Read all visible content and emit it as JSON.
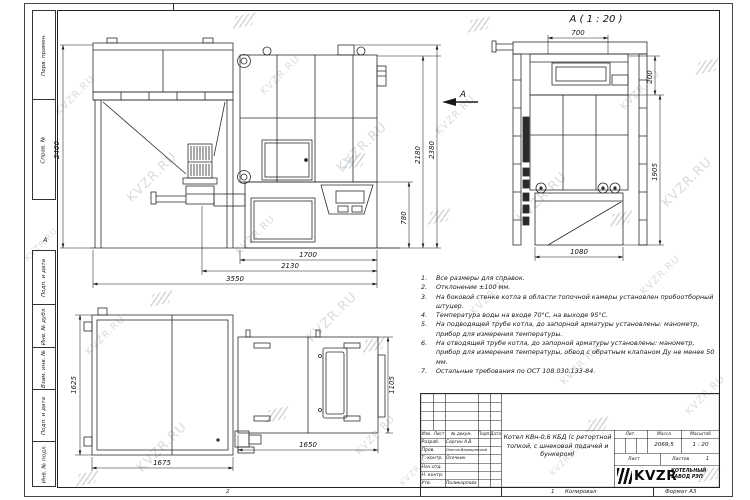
{
  "watermark": "KVZR.RU",
  "frame": {
    "margin_labels": [
      "Перв. примен.",
      "Справ. №",
      "Подп. и дата",
      "Инв. № дубл.",
      "Взам. инв. №",
      "Подп. и дата",
      "Инв. № подл."
    ],
    "zone_letter_a": "А",
    "zone_numbers": {
      "z2": "2",
      "z1": "1"
    },
    "copied_label": "Копировал",
    "format_label": "Формат А3"
  },
  "views": {
    "front": {
      "arrow_label": "А",
      "dims": {
        "bunker_height": "2400",
        "body_height": "2180",
        "total_height": "2380",
        "base_height": "780",
        "width_boiler": "1700",
        "width_mid": "2130",
        "width_total": "3550"
      }
    },
    "side": {
      "title": "А ( 1 : 20 )",
      "dims": {
        "top_width": "700",
        "top_height": "200",
        "right_height": "1905",
        "bottom_width": "1080"
      }
    },
    "plan": {
      "dims": {
        "bunker_depth": "1625",
        "bunker_width": "1675",
        "boiler_width": "1650",
        "boiler_depth": "1105"
      }
    }
  },
  "notes": {
    "items": [
      {
        "num": "1.",
        "text": "Все размеры для справок."
      },
      {
        "num": "2.",
        "text": "Отклонение ±100 мм."
      },
      {
        "num": "3.",
        "text": "На боковой стенке котла в области топочной камеры установлен пробоотборный штуцер."
      },
      {
        "num": "4.",
        "text": "Температура воды на входе 70°С, на выходе 95°С."
      },
      {
        "num": "5.",
        "text": "На подводящей трубе котла, до запорной арматуры установлены: манометр, прибор для измерения температуры."
      },
      {
        "num": "6.",
        "text": "На отводящей трубе котла, до запорной арматуры установлены: манометр, прибор для измерения температуры, обвод с обратным клапаном Ду не менее 50 мм."
      },
      {
        "num": "7.",
        "text": "Остальные требования по ОСТ 108.030.133-84."
      }
    ]
  },
  "title_block": {
    "header_cols": [
      "Изм.",
      "Лист",
      "№ докум.",
      "Подп.",
      "Дата"
    ],
    "rows": [
      {
        "role": "Разраб.",
        "name": "Сергин А.В."
      },
      {
        "role": "Пров.",
        "name": "Онегов-Верещинский"
      },
      {
        "role": "Т. контр.",
        "name": "Осечкин"
      },
      {
        "role": "Нач.отд.",
        "name": ""
      },
      {
        "role": "Н. контр.",
        "name": ""
      },
      {
        "role": "Утв.",
        "name": "Поликарпова"
      }
    ],
    "title": "Котел КВн-0,6 КБД (с ретортной топкой, с шнековой подачей и бункером)",
    "lit_label": "Лит.",
    "mass_label": "Масса",
    "scale_label": "Масштаб",
    "mass": "2069,5",
    "scale": "1 : 20",
    "sheet_label": "Лист",
    "sheets_label": "Листов",
    "sheets_value": "1",
    "logo_text": "KVZR",
    "company": "КОТЕЛЬНЫЙ ЗАВОД РЭП"
  }
}
